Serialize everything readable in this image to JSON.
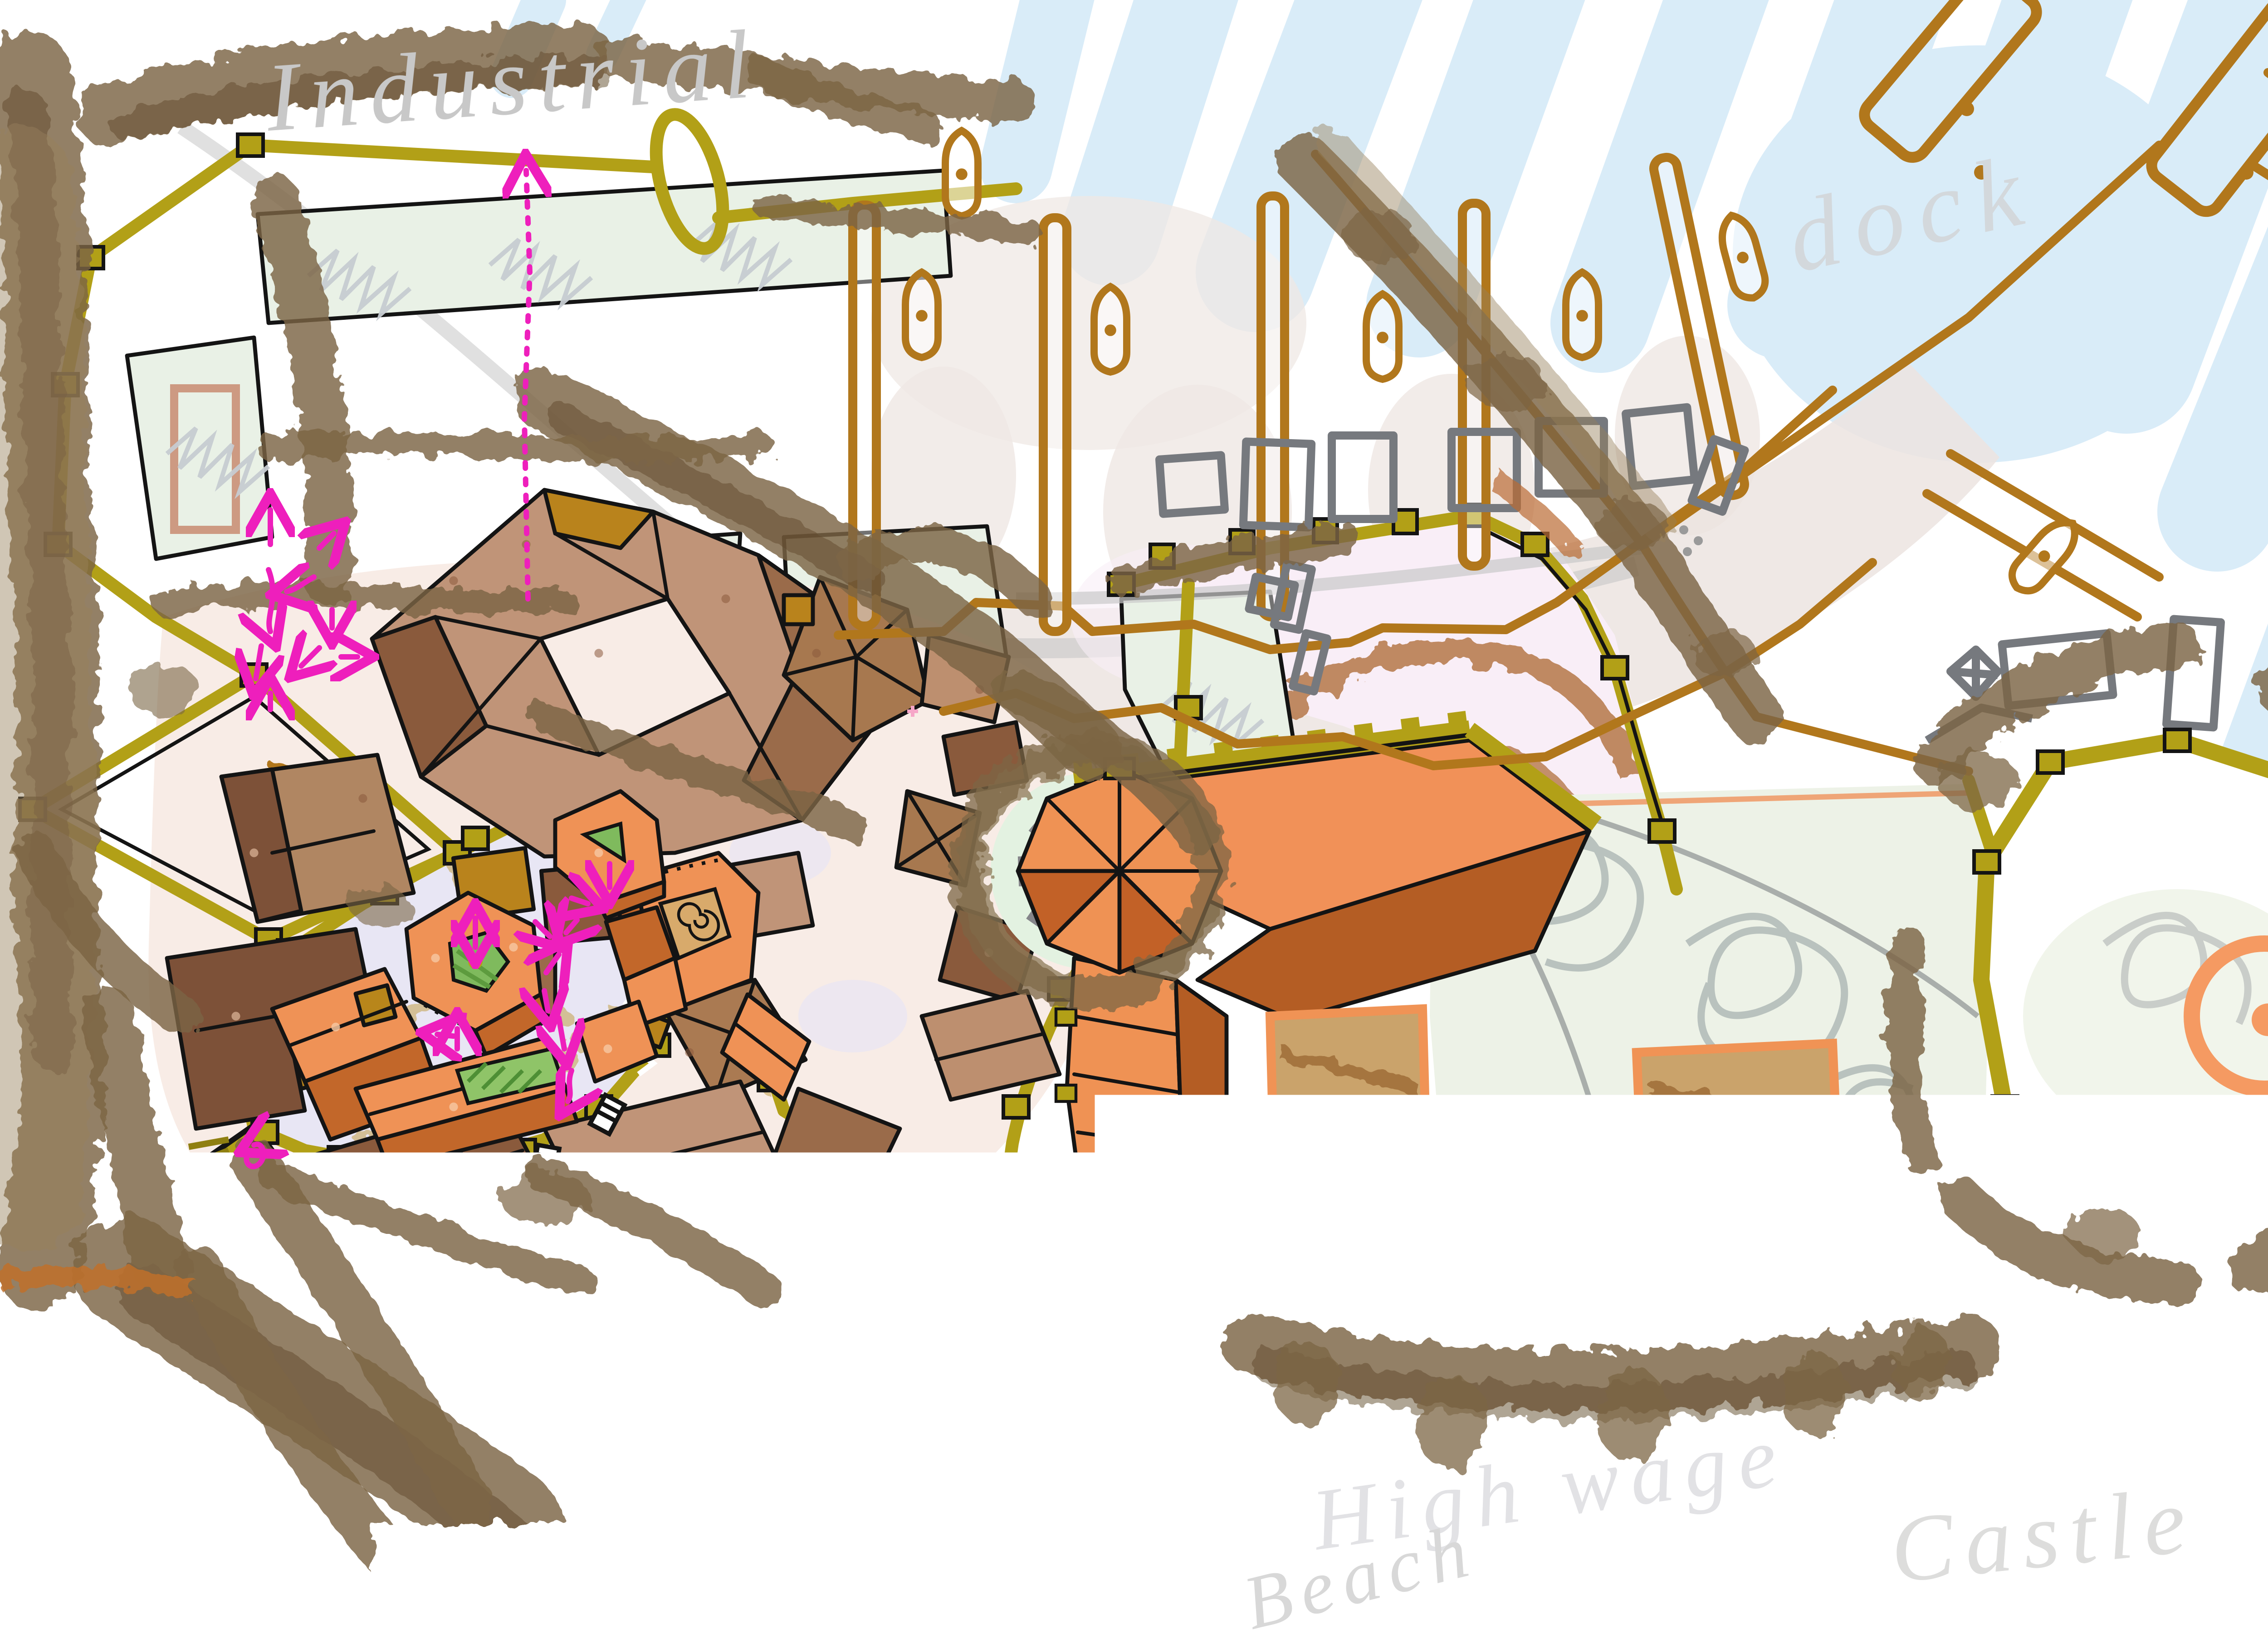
{
  "map": {
    "kind": "hand-drawn city plan sketch",
    "labels": {
      "industrial": "Industrial",
      "dock": "dock",
      "castle": "Castle",
      "high_wage": "High wage",
      "beach": "Beach"
    },
    "districts": [
      "industrial quarter",
      "dock piers",
      "old town",
      "lower town",
      "castle keep",
      "castle courtyard",
      "stone circle plaza",
      "east bastion",
      "beach",
      "forest",
      "amphitheater field"
    ],
    "palette": {
      "paper": "#ffffff",
      "water": "#d9ecf8",
      "forest_brown": "#7c6544",
      "city_wall_olive": "#b2a017",
      "ink_outline": "#141414",
      "roof_light_tan": "#c09478",
      "roof_mid_brown": "#9a6b4a",
      "roof_dark_brown": "#7d5138",
      "roof_gold": "#b9831c",
      "roof_salmon": "#ef9256",
      "roof_rust": "#b45d24",
      "roof_dark_orange": "#c2672a",
      "courtyard_green": "#7fba5d",
      "field_mint": "#e9f1e6",
      "street_lavender": "#e8e6f4",
      "precinct_pink": "#f9eef7",
      "plot_rose": "#cd9a82",
      "beach_sand": "#f7f4d7",
      "harbor_beige": "#ece4e0",
      "dock_brown": "#b1771c",
      "stone_gray": "#85858a",
      "sketch_gray": "#c6cbd1",
      "route_magenta": "#ee1fbc",
      "ring_orange": "#f28b4e",
      "trim_orange": "#f09355",
      "handwriting_gray": "#c9c9c9"
    }
  }
}
